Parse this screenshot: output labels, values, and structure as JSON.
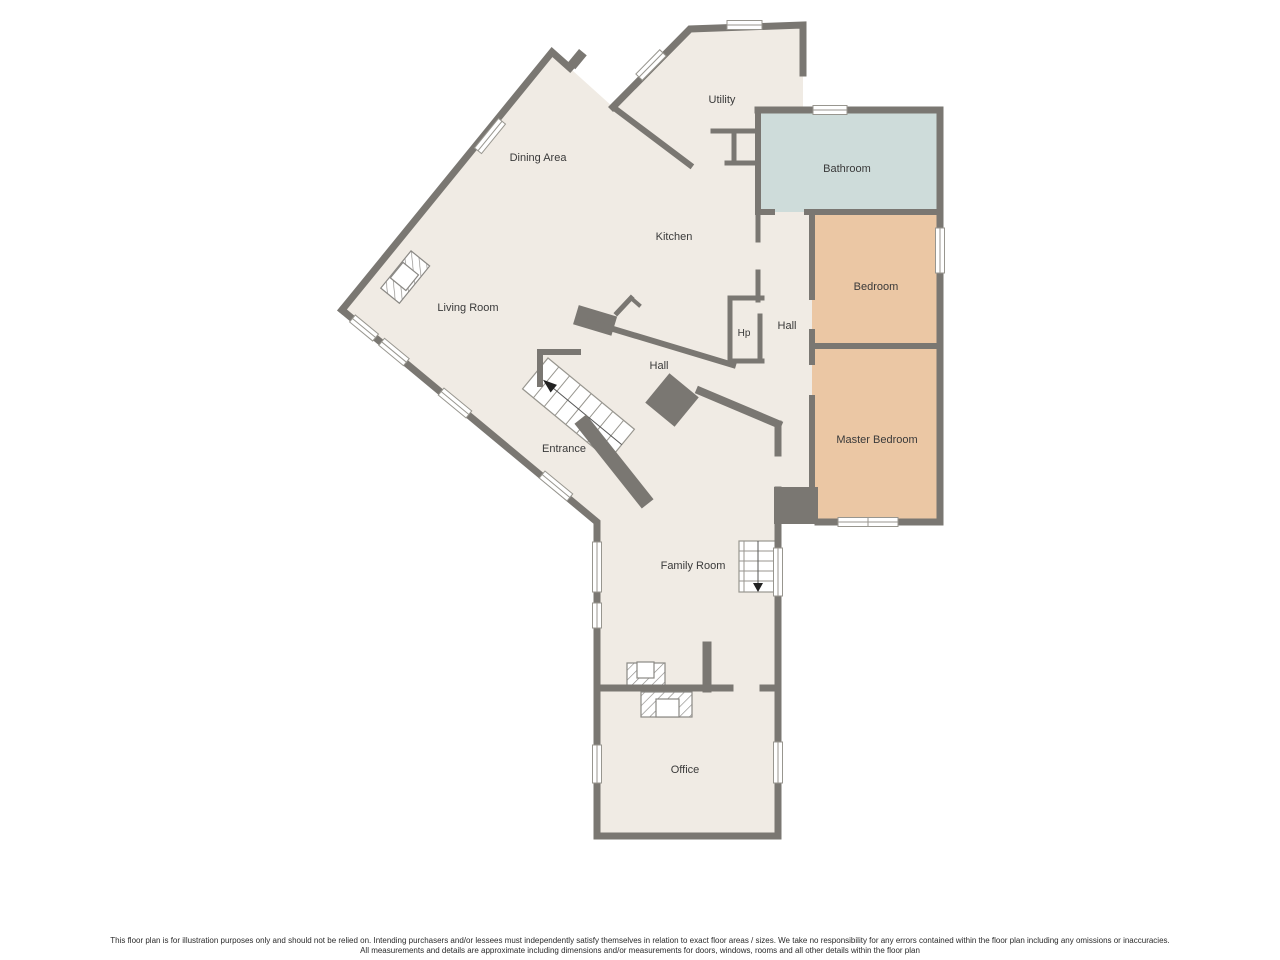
{
  "plan": {
    "title": "Floor plan",
    "rooms": {
      "utility": {
        "label": "Utility"
      },
      "dining": {
        "label": "Dining Area"
      },
      "kitchen": {
        "label": "Kitchen"
      },
      "bathroom": {
        "label": "Bathroom",
        "color": "#cedcda"
      },
      "bedroom": {
        "label": "Bedroom",
        "color": "#ebc7a4"
      },
      "hall_bedrooms": {
        "label": "Hall"
      },
      "hp": {
        "label": "Hp"
      },
      "master_bedroom": {
        "label": "Master Bedroom",
        "color": "#ebc7a4"
      },
      "living_room": {
        "label": "Living Room"
      },
      "hall_main": {
        "label": "Hall"
      },
      "entrance": {
        "label": "Entrance"
      },
      "family_room": {
        "label": "Family Room"
      },
      "office": {
        "label": "Office"
      }
    },
    "stairs": {
      "entrance_stairs": {
        "direction": "up"
      },
      "family_room_stairs": {
        "direction": "down"
      }
    },
    "colors": {
      "floor": "#f0ebe4",
      "wall": "#7a7772",
      "bathroom": "#cedcda",
      "bedroom": "#ebc7a4",
      "window_line": "#98968f",
      "label_text": "#3a3a3a"
    }
  },
  "disclaimer": {
    "line1": "This floor plan is for illustration purposes only and should not be relied on. Intending purchasers and/or lessees must independently satisfy themselves in relation to exact floor areas / sizes. We take no responsibility for any errors contained within the floor plan including any omissions or inaccuracies.",
    "line2": "All measurements and details are approximate including dimensions and/or measurements for doors, windows, rooms and all other details within the floor plan"
  }
}
